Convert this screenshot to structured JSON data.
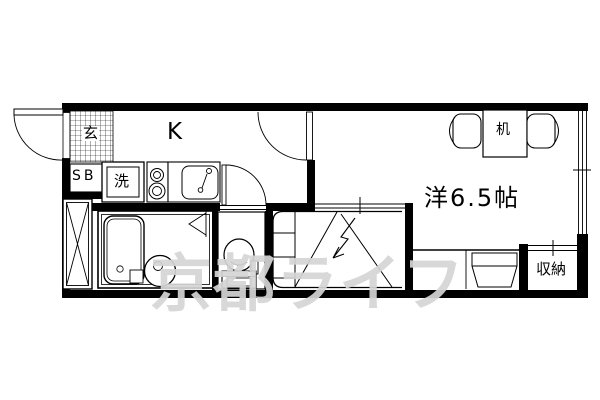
{
  "watermark": {
    "text": "京都ライフ",
    "color": "#d5d5d5"
  },
  "labels": {
    "entrance": "玄",
    "shoe_cabinet": "SB",
    "laundry": "洗",
    "kitchen": "K",
    "desk": "机",
    "main_room": "洋6.5帖",
    "storage": "収納"
  },
  "colors": {
    "walls": "#000000",
    "background": "#ffffff",
    "lines": "#000000"
  },
  "fixtures": [
    "entrance-door-swing",
    "genkan-tile-hatch",
    "pipe-space-x",
    "washing-machine-pan",
    "two-burner-stove",
    "kitchen-sink",
    "room-door-swing",
    "toilet-door-swing",
    "unit-bath",
    "bathtub",
    "wash-basin",
    "toilet",
    "folding-bath-door",
    "loft-stairs",
    "stairs-up-arrow",
    "desk-with-chairs",
    "right-side-window",
    "storage-sliding-door",
    "loft-edge-line",
    "under-loft-chest"
  ]
}
